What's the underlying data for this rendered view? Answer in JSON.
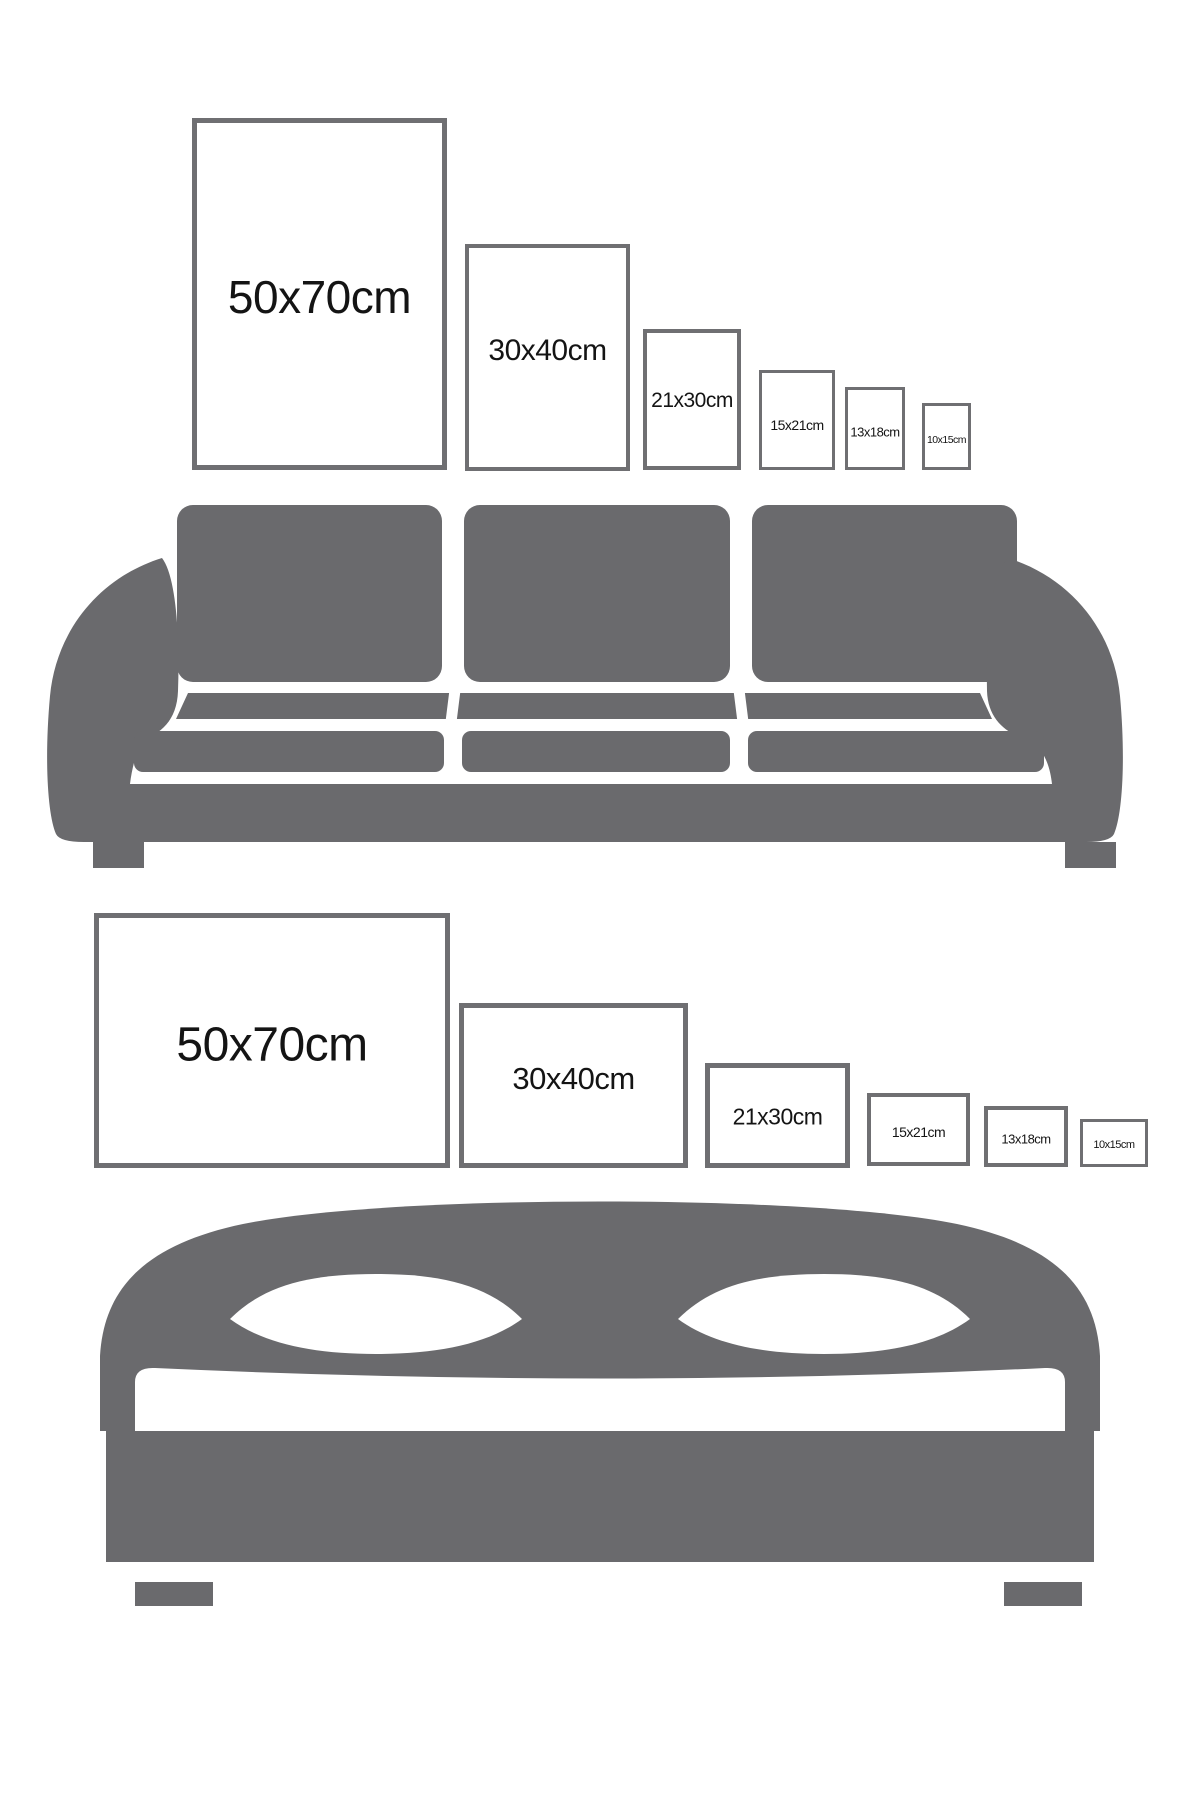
{
  "colors": {
    "background": "#ffffff",
    "furniture_gray": "#6a6a6d",
    "frame_border": "#6f6f72",
    "label_text": "#141414"
  },
  "top_section": {
    "furniture_icon": "sofa-icon",
    "frame_orientation": "portrait",
    "frames": [
      {
        "label": "50x70cm"
      },
      {
        "label": "30x40cm"
      },
      {
        "label": "21x30cm"
      },
      {
        "label": "15x21cm"
      },
      {
        "label": "13x18cm"
      },
      {
        "label": "10x15cm"
      }
    ]
  },
  "bottom_section": {
    "furniture_icon": "bed-icon",
    "frame_orientation": "landscape",
    "frames": [
      {
        "label": "50x70cm"
      },
      {
        "label": "30x40cm"
      },
      {
        "label": "21x30cm"
      },
      {
        "label": "15x21cm"
      },
      {
        "label": "13x18cm"
      },
      {
        "label": "10x15cm"
      }
    ]
  }
}
